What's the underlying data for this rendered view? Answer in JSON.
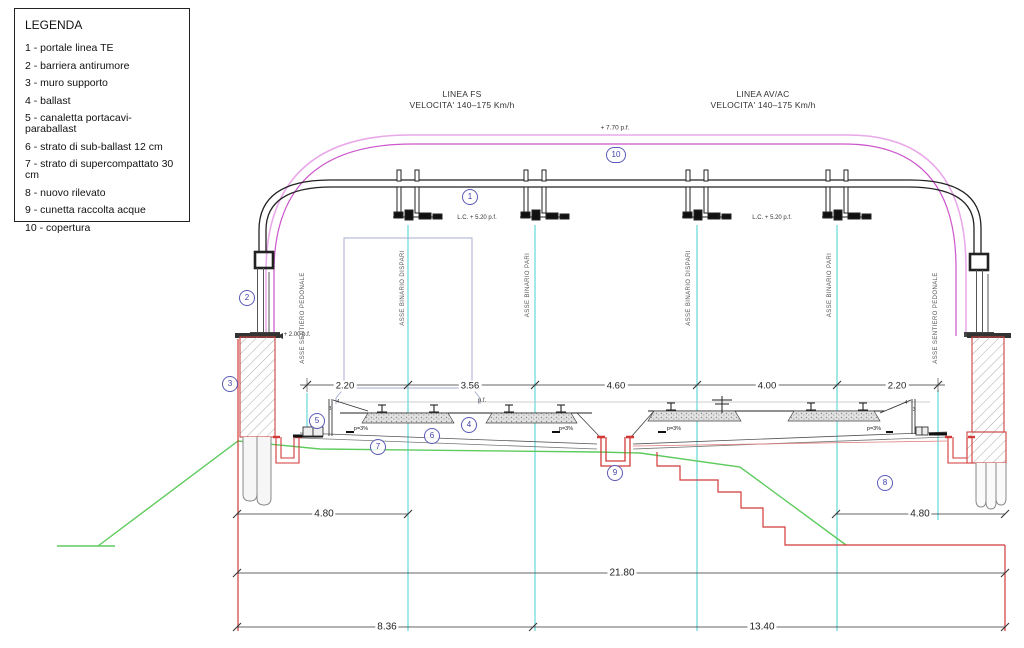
{
  "legend": {
    "title": "LEGENDA",
    "items": [
      "1 - portale linea TE",
      "2 - barriera antirumore",
      "3 - muro supporto",
      "4 - ballast",
      "5 - canaletta portacavi-paraballast",
      "6 - strato di sub-ballast 12 cm",
      "7 - strato di supercompattato 30 cm",
      "8 - nuovo rilevato",
      "9 - cunetta raccolta acque",
      "10 - copertura"
    ]
  },
  "titles": {
    "fs_line1": "LINEA FS",
    "fs_line2": "VELOCITA' 140–175 Km/h",
    "av_line1": "LINEA AV/AC",
    "av_line2": "VELOCITA' 140–175 Km/h"
  },
  "levels": {
    "roof": "+ 7.70 p.f.",
    "catenary_left": "L.C. + 5.20 p.f.",
    "catenary_right": "L.C. + 5.20 p.f.",
    "wall_top": "+ 2.00 p.f."
  },
  "axis_labels": [
    "ASSE SENTIERO PEDONALE",
    "ASSE BINARIO DISPARI",
    "ASSE BINARIO PARI",
    "ASSE BINARIO DISPARI",
    "ASSE BINARIO PARI",
    "ASSE SENTIERO PEDONALE"
  ],
  "dimensions": {
    "track_row": [
      "2.20",
      "3.56",
      "4.60",
      "4.00",
      "2.20"
    ],
    "wall_offset_left": "4.80",
    "wall_offset_right": "4.80",
    "total_width": "21.80",
    "bottom_left": "8.36",
    "bottom_right": "13.40"
  },
  "annotations": {
    "slope": "p=3%",
    "rail_plane": "p.f.",
    "slope_ratio_v": "4",
    "slope_ratio_h": "3"
  },
  "markers": [
    "1",
    "2",
    "3",
    "4",
    "5",
    "6",
    "7",
    "8",
    "9",
    "10"
  ],
  "colors": {
    "cover_magenta": "#cc55cc",
    "cover_pink": "#e9a8e9",
    "track_axis_cyan": "#55d6d6",
    "excavation_red": "#d23a3a",
    "terrain_green": "#5ecb5e",
    "marker_blue": "#5a5ab8"
  }
}
